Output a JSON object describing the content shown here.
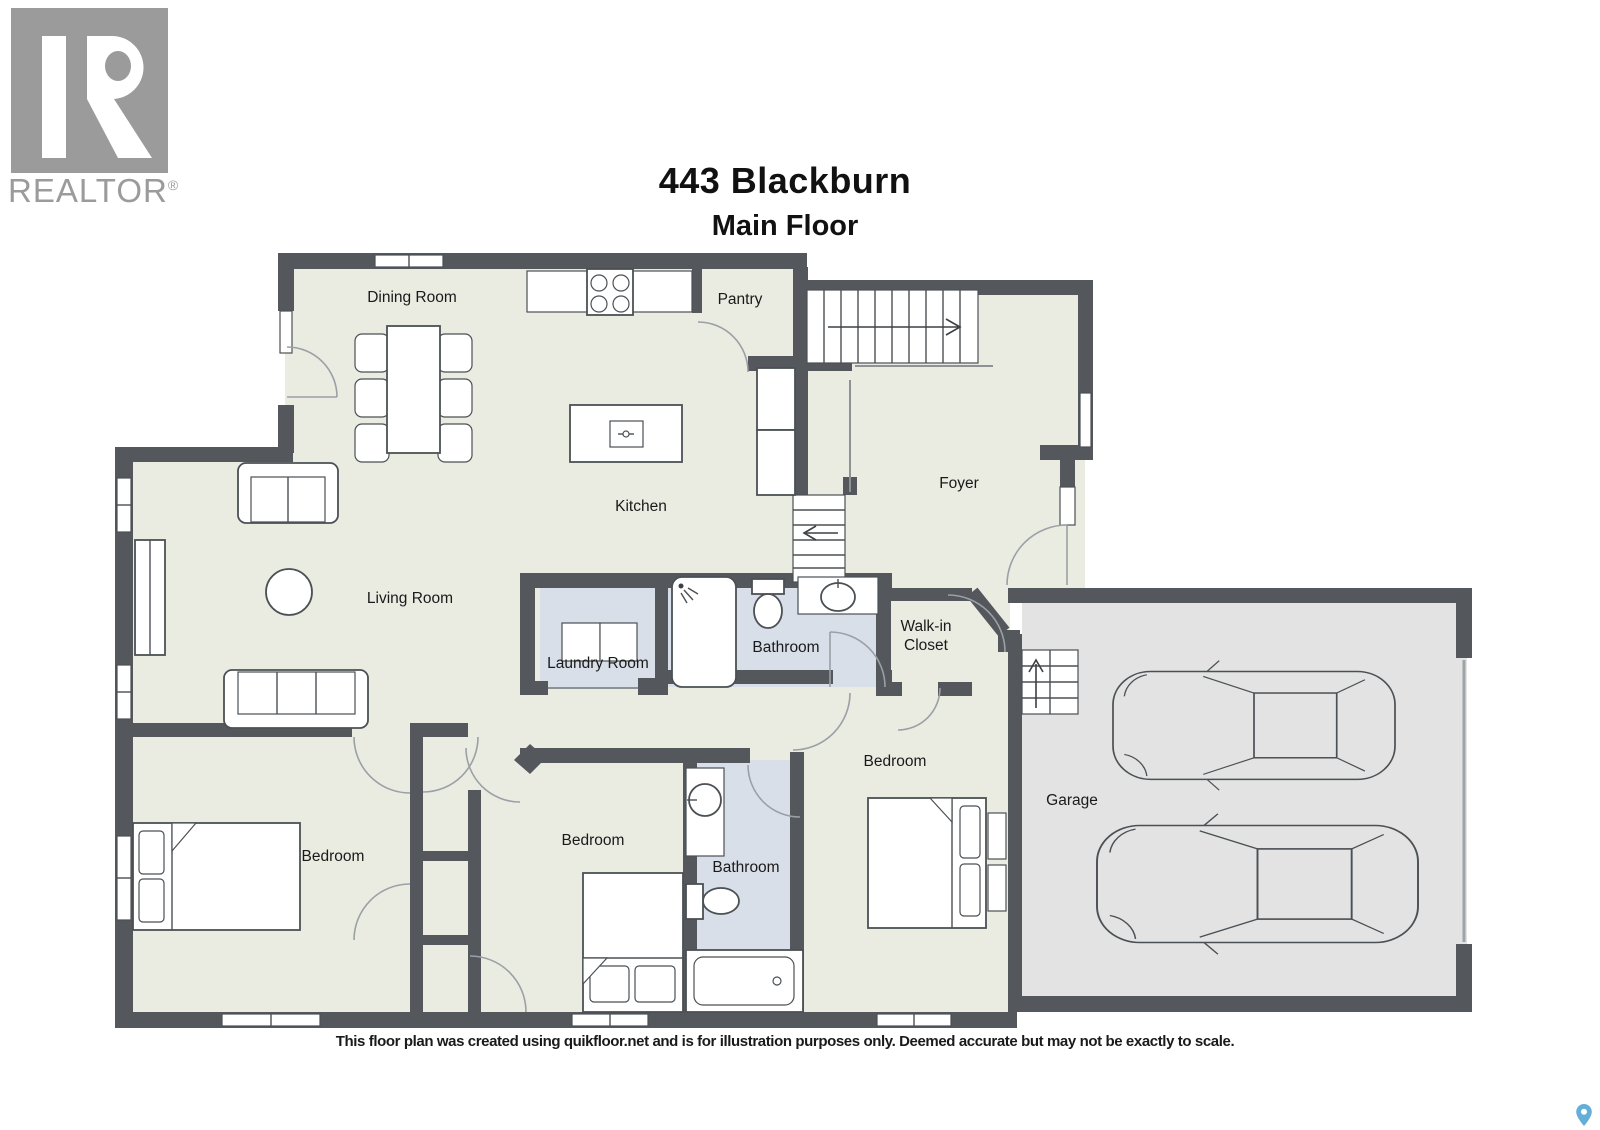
{
  "branding": {
    "realtor_logo_text": "REALTOR",
    "registered_mark": "®"
  },
  "header": {
    "title": "443 Blackburn",
    "subtitle": "Main Floor"
  },
  "rooms": {
    "dining": "Dining Room",
    "pantry": "Pantry",
    "kitchen": "Kitchen",
    "foyer": "Foyer",
    "living": "Living Room",
    "laundry": "Laundry Room",
    "bathroom_main": "Bathroom",
    "walk_in_line1": "Walk-in",
    "walk_in_line2": "Closet",
    "bedroom_left": "Bedroom",
    "bedroom_middle": "Bedroom",
    "bedroom_right": "Bedroom",
    "bathroom_second": "Bathroom",
    "garage": "Garage"
  },
  "footer": {
    "disclaimer": "This floor plan was created using quikfloor.net and is for illustration purposes only. Deemed accurate but may not be exactly to scale."
  },
  "icons": {
    "bottom_right": "map-pin-icon"
  },
  "colors": {
    "wall": "#54585c",
    "floor": "#eaebe1",
    "wet_floor": "#d9dfe8",
    "garage_floor": "#e2e3e2",
    "line": "#4b5054",
    "door_arc": "#9aa0a5",
    "pin_blue": "#64aed8",
    "logo_gray": "#9b9b9b",
    "text": "#111111"
  }
}
